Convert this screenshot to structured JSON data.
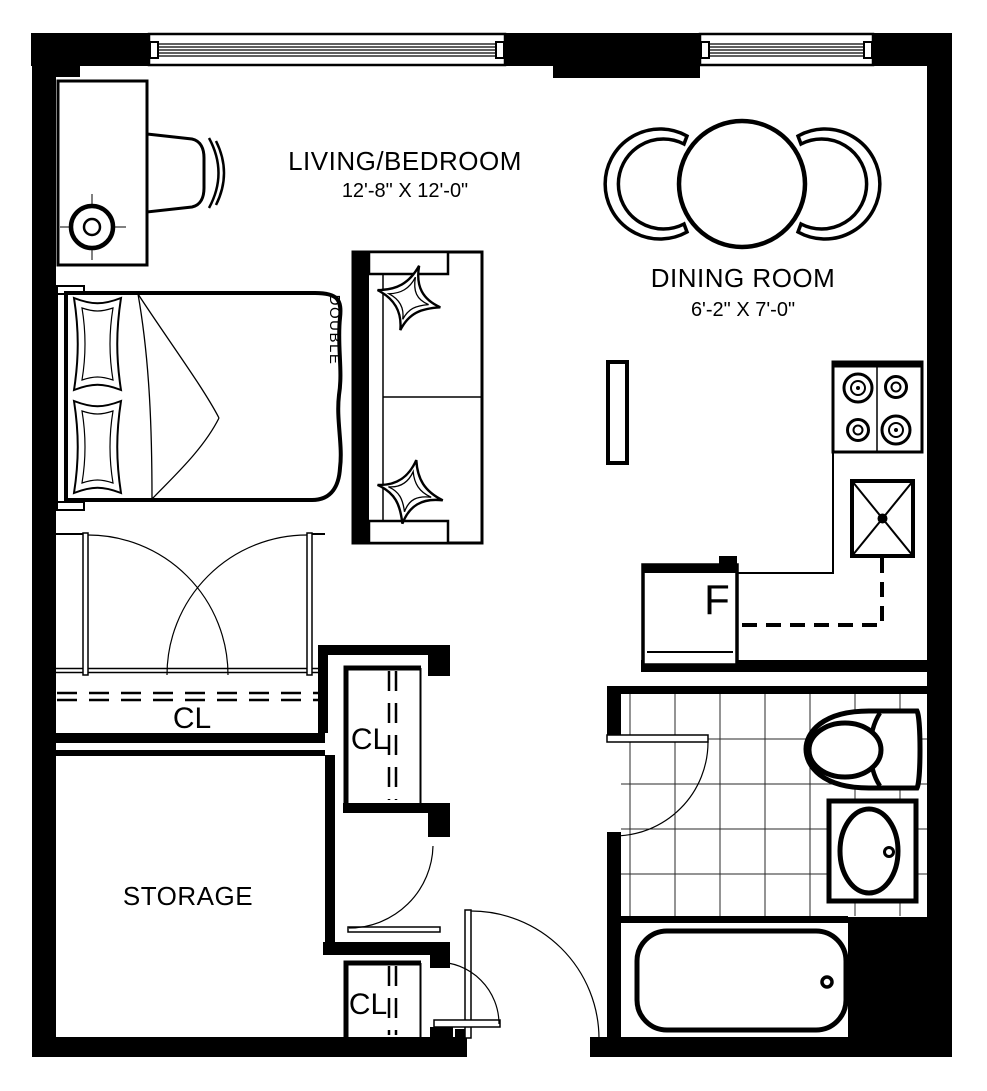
{
  "plan": {
    "background": "#ffffff",
    "line_color": "#000000",
    "rooms": {
      "living_bedroom": {
        "name": "LIVING/BEDROOM",
        "dims": "12'-8\" X 12'-0\""
      },
      "dining_room": {
        "name": "DINING ROOM",
        "dims": "6'-2\" X 7'-0\""
      },
      "storage": {
        "name": "STORAGE"
      },
      "closet_bedroom": {
        "label": "CL"
      },
      "closet_hall": {
        "label": "CL"
      },
      "closet_entry": {
        "label": "CL"
      }
    },
    "labels": {
      "fridge": "F",
      "bed_size": "DOUBLE"
    }
  }
}
